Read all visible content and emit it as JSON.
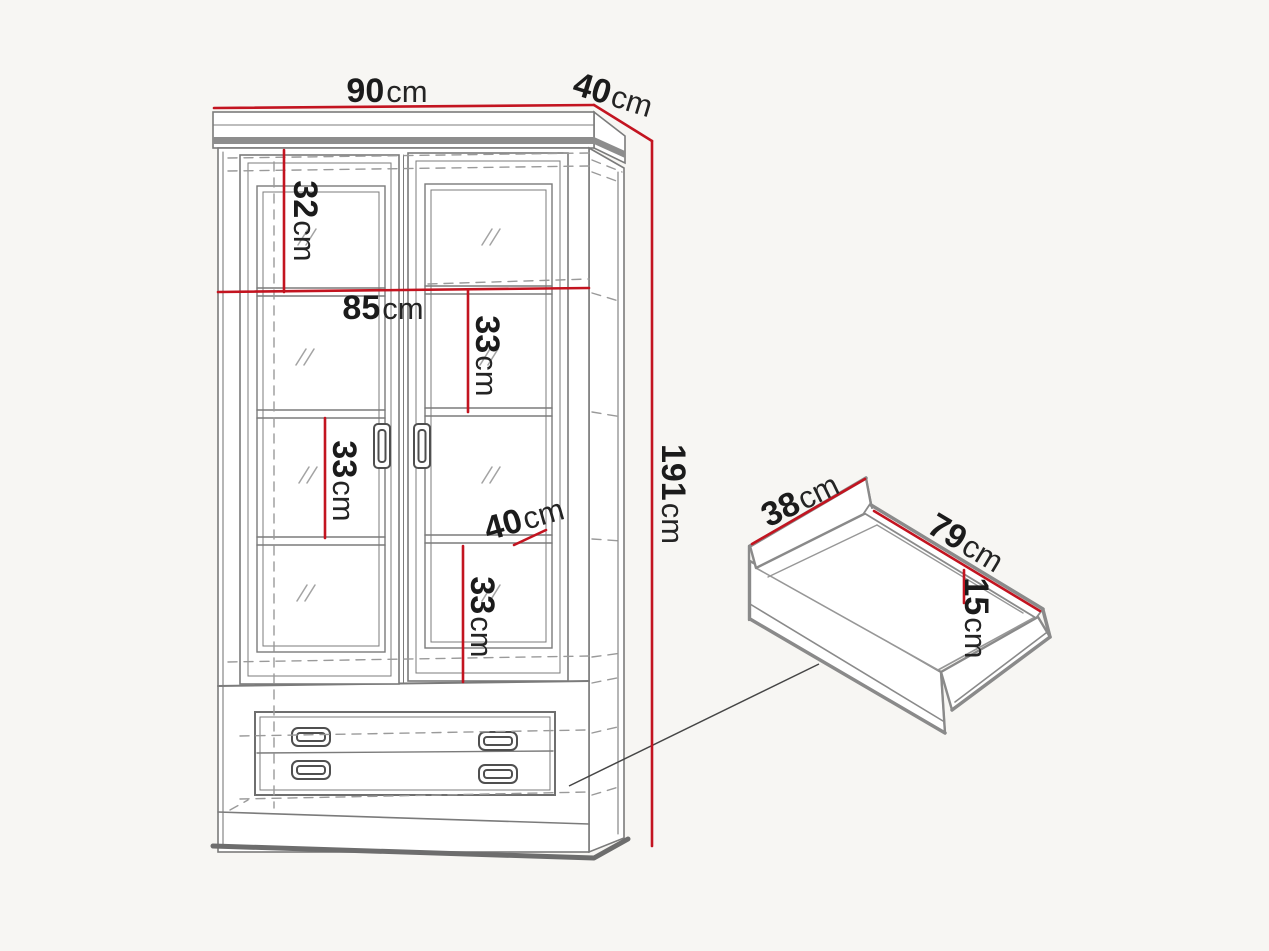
{
  "colors": {
    "dimension_line": "#c31420",
    "drawing_line": "#7b7b7b",
    "dark_edge": "#6d6d6d",
    "dashed_line": "#9a9a9a",
    "label_text": "#1b1b1b",
    "background": "#f7f6f3"
  },
  "cabinet": {
    "dimensions": {
      "width": {
        "value": "90",
        "unit": "cm"
      },
      "depth": {
        "value": "40",
        "unit": "cm"
      },
      "height": {
        "value": "191",
        "unit": "cm"
      },
      "top_section_height": {
        "value": "32",
        "unit": "cm"
      },
      "interior_width": {
        "value": "85",
        "unit": "cm"
      },
      "upper_shelf_height": {
        "value": "33",
        "unit": "cm"
      },
      "middle_shelf_height": {
        "value": "33",
        "unit": "cm"
      },
      "shelf_depth": {
        "value": "40",
        "unit": "cm"
      },
      "lower_shelf_height": {
        "value": "33",
        "unit": "cm"
      }
    }
  },
  "drawer": {
    "dimensions": {
      "depth": {
        "value": "38",
        "unit": "cm"
      },
      "width": {
        "value": "79",
        "unit": "cm"
      },
      "height": {
        "value": "15",
        "unit": "cm"
      }
    }
  }
}
